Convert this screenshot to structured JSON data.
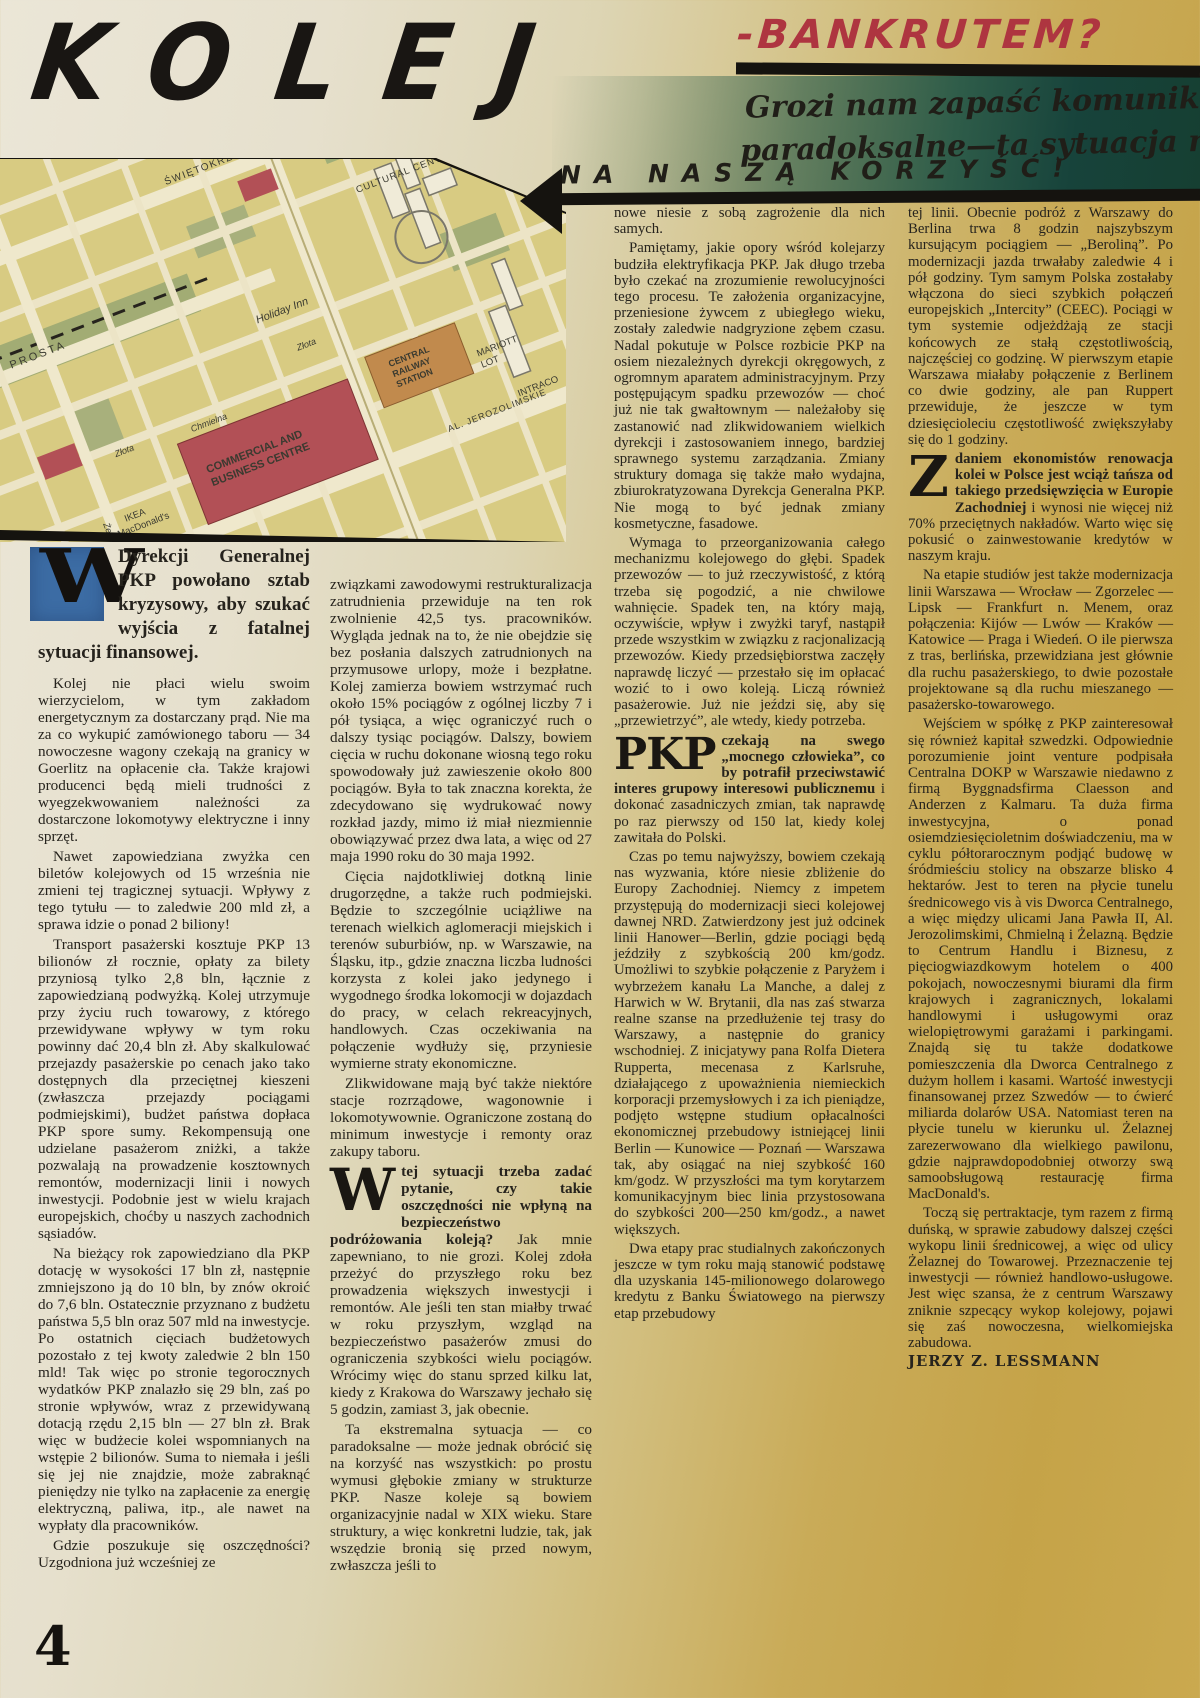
{
  "masthead": {
    "title": "KOLEJ",
    "title_suffix": "-BANKRUTEM?",
    "deck_line1": "Grozi nam zapaść komunikacyjna! Co",
    "deck_line2": "paradoksalne—ta sytuacja może się obrócić",
    "deck_line3": "NA NASZĄ KORZYŚĆ!"
  },
  "colors": {
    "headline_black": "#191613",
    "accent_red": "#ae3540",
    "teal_band": "#163f32",
    "page_gold": "#c5a348",
    "page_cream": "#ebe6d7",
    "dropcap_blue": "#3c6ca4",
    "map_ground": "#d8cb82"
  },
  "map": {
    "labels": {
      "swietokrzyska": "ŚWIĘTOKRZYSKA",
      "prosta": "PROSTA",
      "holiday_inn": "Holiday Inn",
      "zlota_a": "Złota",
      "zlota_b": "Złota",
      "chmielna": "Chmielna",
      "zelazna": "Żelazna",
      "jerozolimskie": "AL. JEROZOLIMSKIE",
      "cultural_centre": "CULTURAL CENTRE",
      "cbc_line1": "COMMERCIAL AND",
      "cbc_line2": "BUSINESS CENTRE",
      "station_line1": "CENTRAL",
      "station_line2": "RAILWAY",
      "station_line3": "STATION",
      "marriott_line1": "MARIOTT",
      "marriott_line2": "LOT",
      "intraco": "INTRACO",
      "ikea_line1": "IKEA",
      "ikea_line2": "MacDonald's"
    }
  },
  "article": {
    "col1": {
      "dropcap": "W",
      "lead_rest": "Dyrekcji Generalnej PKP powołano sztab kryzysowy, aby szukać wyjścia z fatalnej sytuacji finansowej.",
      "paras": [
        "Kolej nie płaci wielu swoim wierzycielom, w tym zakładom energetycznym za dostarczany prąd. Nie ma za co wykupić zamówionego taboru — 34 nowoczesne wagony czekają na granicy w Goerlitz na opłacenie cła. Także krajowi producenci będą mieli trudności z wyegzekwowaniem należności za dostarczone lokomotywy elektryczne i inny sprzęt.",
        "Nawet zapowiedziana zwyżka cen biletów kolejowych od 15 września nie zmieni tej tragicznej sytuacji. Wpływy z tego tytułu — to zaledwie 200 mld zł, a sprawa idzie o ponad 2 biliony!",
        "Transport pasażerski kosztuje PKP 13 bilionów zł rocznie, opłaty za bilety przyniosą tylko 2,8 bln, łącznie z zapowiedzianą podwyżką. Kolej utrzymuje przy życiu ruch towarowy, z którego przewidywane wpływy w tym roku powinny dać 20,4 bln zł. Aby skalkulować przejazdy pasażerskie po cenach jako tako dostępnych dla przeciętnej kieszeni (zwłaszcza przejazdy pociągami podmiejskimi), budżet państwa dopłaca PKP spore sumy. Rekompensują one udzielane pasażerom zniżki, a także pozwalają na prowadzenie kosztownych remontów, modernizacji linii i nowych inwestycji. Podobnie jest w wielu krajach europejskich, choćby u naszych zachodnich sąsiadów.",
        "Na bieżący rok zapowiedziano dla PKP dotację w wysokości 17 bln zł, następnie zmniejszono ją do 10 bln, by znów okroić do 7,6 bln. Ostatecznie przyznano z budżetu państwa 5,5 bln oraz 507 mld na inwestycje. Po ostatnich cięciach budżetowych pozostało z tej kwoty zaledwie 2 bln 150 mld! Tak więc po stronie tegorocznych wydatków PKP znalazło się 29 bln, zaś po stronie wpływów, wraz z przewidywaną dotacją rzędu 2,15 bln — 27 bln zł. Brak więc w budżecie kolei wspomnianych na wstępie 2 bilionów. Suma to niemała i jeśli się jej nie znajdzie, może zabraknąć pieniędzy nie tylko na zapłacenie za energię elektryczną, paliwa, itp., ale nawet na wypłaty dla pracowników.",
        "Gdzie poszukuje się oszczędności? Uzgodniona już wcześniej ze"
      ]
    },
    "col2": {
      "paras_before": [
        "związkami zawodowymi restrukturalizacja zatrudnienia przewiduje na ten rok zwolnienie 42,5 tys. pracowników. Wygląda jednak na to, że nie obejdzie się bez posłania dalszych zatrudnionych na przymusowe urlopy, może i bezpłatne. Kolej zamierza bowiem wstrzymać ruch około 15% pociągów z ogólnej liczby 7 i pół tysiąca, a więc ograniczyć ruch o dalszy tysiąc pociągów. Dalszy, bowiem cięcia w ruchu dokonane wiosną tego roku spowodowały już zawieszenie około 800 pociągów. Była to tak znaczna korekta, że zdecydowano się wydrukować nowy rozkład jazdy, mimo iż miał niezmiennie obowiązywać przez dwa lata, a więc od 27 maja 1990 roku do 30 maja 1992.",
        "Cięcia najdotkliwiej dotkną linie drugorzędne, a także ruch podmiejski. Będzie to szczególnie uciążliwe na terenach wielkich aglomeracji miejskich i terenów suburbiów, np. w Warszawie, na Śląsku, itp., gdzie znaczna liczba ludności korzysta z kolei jako jedynego i wygodnego środka lokomocji w dojazdach do pracy, w celach rekreacyjnych, handlowych. Czas oczekiwania na połączenie wydłuży się, przyniesie wymierne straty ekonomiczne.",
        "Zlikwidowane mają być także niektóre stacje rozrządowe, wagonownie i lokomotywownie. Ograniczone zostaną do minimum inwestycje i remonty oraz zakupy taboru."
      ],
      "dropcap": "W",
      "w_bold": "tej sytuacji trzeba zadać pytanie, czy takie oszczędności nie wpłyną na bezpieczeństwo podróżowania koleją?",
      "w_rest": "Jak mnie zapewniano, to nie grozi. Kolej zdoła przeżyć do przyszłego roku bez prowadzenia większych inwestycji i remontów. Ale jeśli ten stan miałby trwać w roku przyszłym, wzgląd na bezpieczeństwo pasażerów zmusi do ograniczenia szybkości wielu pociągów. Wrócimy więc do stanu sprzed kilku lat, kiedy z Krakowa do Warszawy jechało się 5 godzin, zamiast 3, jak obecnie.",
      "paras_after": [
        "Ta ekstremalna sytuacja — co paradoksalne — może jednak obrócić się na korzyść nas wszystkich: po prostu wymusi głębokie zmiany w strukturze PKP. Nasze koleje są bowiem organizacyjnie nadal w XIX wieku. Stare struktury, a więc konkretni ludzie, tak, jak wszędzie bronią się przed nowym, zwłaszcza jeśli to"
      ]
    },
    "col3": {
      "paras_before": [
        "nowe niesie z sobą zagrożenie dla nich samych.",
        "Pamiętamy, jakie opory wśród kolejarzy budziła elektryfikacja PKP. Jak długo trzeba było czekać na zrozumienie rewolucyjności tego procesu. Te założenia organizacyjne, przeniesione żywcem z ubiegłego wieku, zostały zaledwie nadgryzione zębem czasu. Nadal pokutuje w Polsce rozbicie PKP na osiem niezależnych dyrekcji okręgowych, z ogromnym aparatem administracyjnym. Przy postępującym spadku przewozów — choć już nie tak gwałtownym — należałoby się zastanowić nad zlikwidowaniem wielkich dyrekcji i zastosowaniem innego, bardziej sprawnego systemu zarządzania. Zmiany struktury domaga się także mało wydajna, zbiurokratyzowana Dyrekcja Generalna PKP. Nie mogą to być jednak zmiany kosmetyczne, fasadowe.",
        "Wymaga to przeorganizowania całego mechanizmu kolejowego do głębi. Spadek przewozów — to już rzeczywistość, z którą trzeba się pogodzić, a nie chwilowe wahnięcie. Spadek ten, na który mają, oczywiście, wpływ i zwyżki taryf, nastąpił przede wszystkim w związku z racjonalizacją przewozów. Kiedy przedsiębiorstwa zaczęły naprawdę liczyć — przestało się im opłacać wozić to i owo koleją. Liczą również pasażerowie. Już nie jeździ się, aby się „przewietrzyć”, ale wtedy, kiedy potrzeba."
      ],
      "dropcap": "PKP",
      "pkp_bold": "czekają na swego „mocnego człowieka”, co by potrafił przeciwstawić interes grupowy interesowi publicznemu",
      "pkp_rest": "i dokonać zasadniczych zmian, tak naprawdę po raz pierwszy od 150 lat, kiedy kolej zawitała do Polski.",
      "paras_after": [
        "Czas po temu najwyższy, bowiem czekają nas wyzwania, które niesie zbliżenie do Europy Zachodniej. Niemcy z impetem przystępują do modernizacji sieci kolejowej dawnej NRD. Zatwierdzony jest już odcinek linii Hanower—Berlin, gdzie pociągi będą jeździły z szybkością 200 km/godz. Umożliwi to szybkie połączenie z Paryżem i wybrzeżem kanału La Manche, a dalej z Harwich w W. Brytanii, dla nas zaś stwarza realne szanse na przedłużenie tej trasy do Warszawy, a następnie do granicy wschodniej. Z inicjatywy pana Rolfa Dietera Rupperta, mecenasa z Karlsruhe, działającego z upoważnienia niemieckich korporacji przemysłowych i za ich pieniądze, podjęto wstępne studium opłacalności ekonomicznej przebudowy istniejącej linii Berlin — Kunowice — Poznań — Warszawa tak, aby osiągać na niej szybkość 160 km/godz. W przyszłości ma tym korytarzem komunikacyjnym biec linia przystosowana do szybkości 200—250 km/godz., a nawet większych.",
        "Dwa etapy prac studialnych zakończonych jeszcze w tym roku mają stanowić podstawę dla uzyskania 145-milionowego dolarowego kredytu z Banku Światowego na pierwszy etap przebudowy"
      ]
    },
    "col4": {
      "paras_before": [
        "tej linii. Obecnie podróż z Warszawy do Berlina trwa 8 godzin najszybszym kursującym pociągiem — „Beroliną”. Po modernizacji jazda trwałaby zaledwie 4 i pół godziny. Tym samym Polska zostałaby włączona do sieci szybkich połączeń europejskich „Intercity” (CEEC). Pociągi w tym systemie odjeżdżają ze stacji końcowych ze stałą częstotliwością, najczęściej co godzinę. W pierwszym etapie Warszawa miałaby połączenie z Berlinem co dwie godziny, ale pan Ruppert przewiduje, że jeszcze w tym dziesięcioleciu częstotliwość zwiększyłaby się do 1 godziny."
      ],
      "dropcap": "Z",
      "z_bold": "daniem ekonomistów renowacja kolei w Polsce jest wciąż tańsza od takiego przedsięwzięcia w Europie Zachodniej",
      "z_rest": "i wynosi nie więcej niż 70% przeciętnych nakładów. Warto więc się pokusić o zainwestowanie kredytów w naszym kraju.",
      "paras_after": [
        "Na etapie studiów jest także modernizacja linii Warszawa — Wrocław — Zgorzelec — Lipsk — Frankfurt n. Menem, oraz połączenia: Kijów — Lwów — Kraków — Katowice — Praga i Wiedeń. O ile pierwsza z tras, berlińska, przewidziana jest głównie dla ruchu pasażerskiego, to dwie pozostałe projektowane są dla ruchu mieszanego — pasażersko-towarowego.",
        "Wejściem w spółkę z PKP zainteresował się również kapitał szwedzki. Odpowiednie porozumienie joint venture podpisała Centralna DOKP w Warszawie niedawno z firmą Byggnadsfirma Claesson and Anderzen z Kalmaru. Ta duża firma inwestycyjna, o ponad osiemdziesięcioletnim doświadczeniu, ma w cyklu półtorarocznym podjąć budowę w śródmieściu stolicy na obszarze blisko 4 hektarów. Jest to teren na płycie tunelu średnicowego vis à vis Dworca Centralnego, a więc między ulicami Jana Pawła II, Al. Jerozolimskimi, Chmielną i Żelazną. Będzie to Centrum Handlu i Biznesu, z pięciogwiazdkowym hotelem o 400 pokojach, nowoczesnymi biurami dla firm krajowych i zagranicznych, lokalami handlowymi i usługowymi oraz wielopiętrowymi garażami i parkingami. Znajdą się tu także dodatkowe pomieszczenia dla Dworca Centralnego z dużym hollem i kasami. Wartość inwestycji finansowanej przez Szwedów — to ćwierć miliarda dolarów USA. Natomiast teren na płycie tunelu w kierunku ul. Żelaznej zarezerwowano dla wielkiego pawilonu, gdzie najprawdopodobniej otworzy swą samoobsługową restaurację firma MacDonald's.",
        "Toczą się pertraktacje, tym razem z firmą duńską, w sprawie zabudowy dalszej części wykopu linii średnicowej, a więc od ulicy Żelaznej do Towarowej. Przeznaczenie tej inwestycji — również handlowo-usługowe. Jest więc szansa, że z centrum Warszawy zniknie szpecący wykop kolejowy, pojawi się zaś nowoczesna, wielkomiejska zabudowa."
      ]
    },
    "author": "JERZY Z. LESSMANN",
    "page_number": "4"
  }
}
